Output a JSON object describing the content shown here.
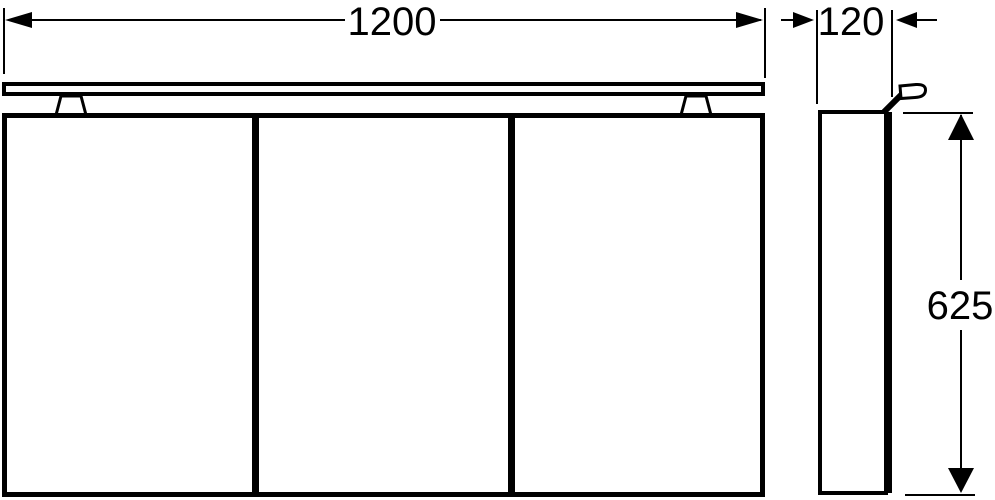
{
  "colors": {
    "line": "#000000",
    "background": "#ffffff"
  },
  "front_view": {
    "width_label": "1200",
    "door_count": 3
  },
  "side_view": {
    "depth_label": "120",
    "height_label": "625"
  }
}
